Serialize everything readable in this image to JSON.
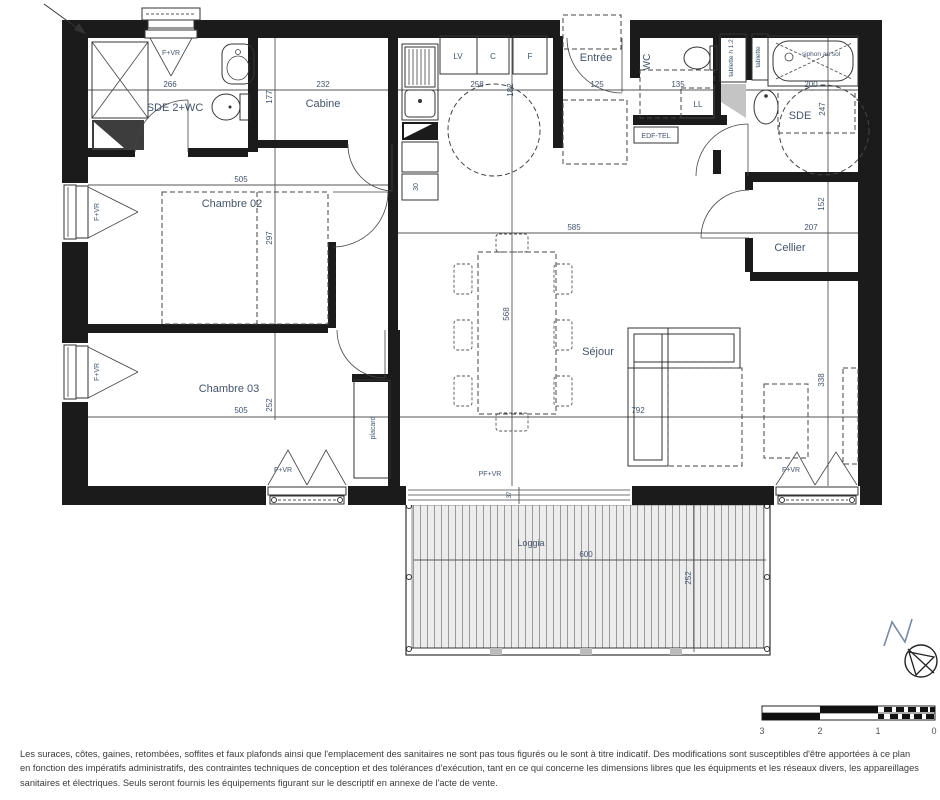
{
  "plan": {
    "rooms": {
      "sde2wc": "SDE 2+WC",
      "cabine": "Cabine",
      "chambre02": "Chambre 02",
      "chambre03": "Chambre 03",
      "entree": "Entrée",
      "wc": "WC",
      "sde": "SDE",
      "cellier": "Cellier",
      "sejour": "Séjour",
      "loggia": "Loggia",
      "placard": "placard"
    },
    "fixtures": {
      "lv": "LV",
      "c": "C",
      "f": "F",
      "ll": "LL",
      "edf_tel": "EDF-TEL",
      "tablette_h12": "tablette h 1.2",
      "tablette": "tablette",
      "siphon": "siphon au sol"
    },
    "openings": {
      "f_vr": "F+VR",
      "pf_vr": "PF+VR"
    },
    "dims": {
      "sde2wc_w": "266",
      "cabine_w": "232",
      "cabine_d": "177",
      "kitchen_w": "258",
      "kitchen_gap": "182",
      "kitchen_unit": "30",
      "entree_w": "125",
      "wc_w": "135",
      "sde_w": "200",
      "sde_d": "247",
      "ch02_w": "505",
      "ch02_d": "297",
      "ch03_w": "505",
      "ch03_d": "252",
      "sejour_w": "585",
      "sejour_d": "568",
      "sejour_l": "792",
      "sejour_r": "338",
      "cellier_w": "207",
      "cellier_d": "152",
      "bay": "37",
      "loggia_w": "600",
      "loggia_d": "252"
    }
  },
  "scale_bar": {
    "ticks": [
      "3",
      "2",
      "1",
      "0"
    ]
  },
  "disclaimer": "Les suraces, côtes, gaines, retombées, soffites et faux plafonds ainsi que l'emplacement des sanitaires ne sont pas tous figurés ou le sont à titre indicatif. Des modifications sont susceptibles d'être apportées à ce plan en fonction des impératifs administratifs, des contraintes techniques de conception et des tolérances d'exécution, tant en ce qui concerne les dimensions libres que les équipments et les réseaux divers, les appareillages sanitaires et électriques. Seuls seront fournis les équipements figurant sur le descriptif en annexe de l'acte de vente.",
  "colors": {
    "wall": "#1b1b1b",
    "dim_text": "#44546b",
    "line": "#555555"
  }
}
